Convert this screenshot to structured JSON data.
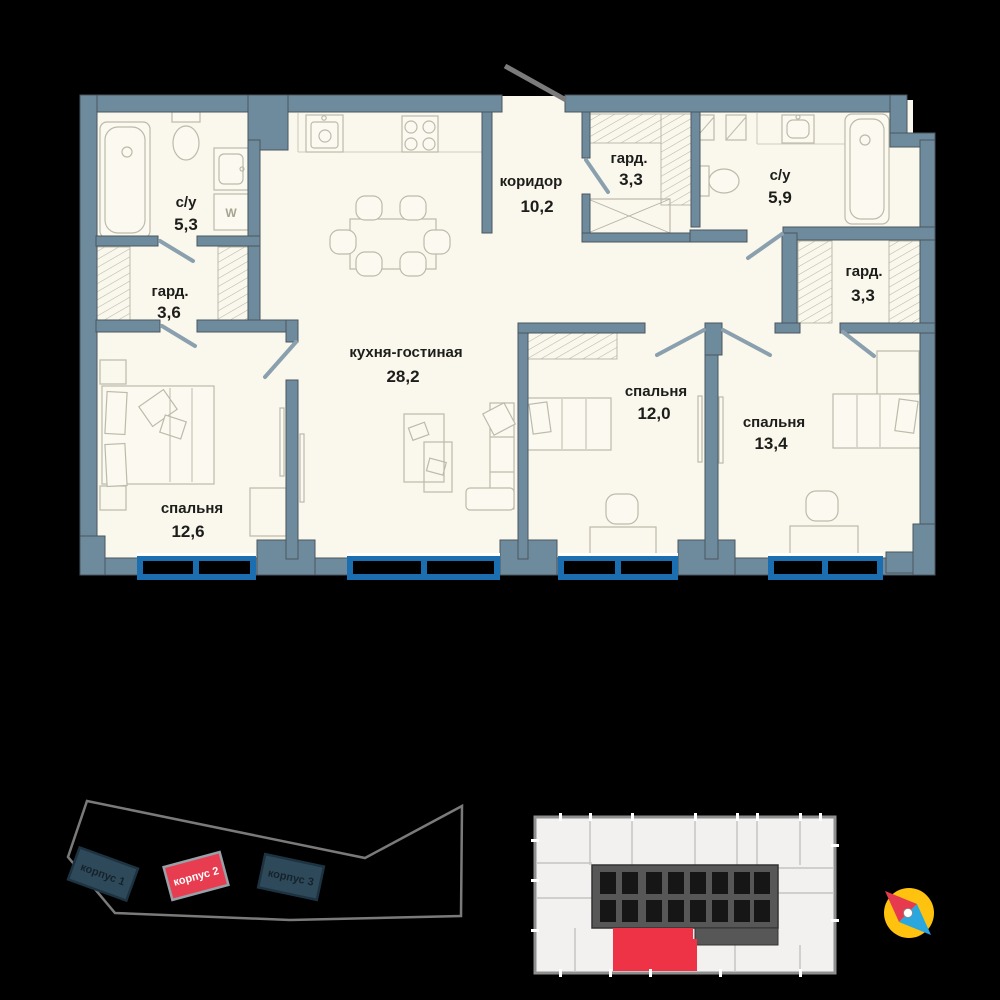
{
  "plan": {
    "rooms": [
      {
        "id": "bathroom-1",
        "name": "с/у",
        "area": "5,3"
      },
      {
        "id": "wardrobe-1",
        "name": "гард.",
        "area": "3,6"
      },
      {
        "id": "bedroom-1",
        "name": "спальня",
        "area": "12,6"
      },
      {
        "id": "kitchen-living",
        "name": "кухня-гостиная",
        "area": "28,2"
      },
      {
        "id": "corridor",
        "name": "коридор",
        "area": "10,2"
      },
      {
        "id": "wardrobe-2",
        "name": "гард.",
        "area": "3,3"
      },
      {
        "id": "bathroom-2",
        "name": "с/у",
        "area": "5,9"
      },
      {
        "id": "wardrobe-3",
        "name": "гард.",
        "area": "3,3"
      },
      {
        "id": "bedroom-2",
        "name": "спальня",
        "area": "12,0"
      },
      {
        "id": "bedroom-3",
        "name": "спальня",
        "area": "13,4"
      }
    ],
    "washer_label": "W",
    "colors": {
      "wall": "#6e8b9d",
      "floor": "#faf8ec",
      "window_frame": "#1b6eb0",
      "background": "#000000"
    }
  },
  "site_plan": {
    "buildings": [
      {
        "label": "корпус 1",
        "highlighted": false
      },
      {
        "label": "корпус 2",
        "highlighted": true
      },
      {
        "label": "корпус 3",
        "highlighted": false
      }
    ],
    "highlight_color": "#e83c50",
    "building_color": "#2e4a5a"
  },
  "key_plan": {
    "highlight_color": "#ee3347",
    "core_color": "#575757"
  },
  "compass": {
    "dial_color": "#ffc20e",
    "north_color": "#e63a4e",
    "south_color": "#2ba7e0"
  }
}
